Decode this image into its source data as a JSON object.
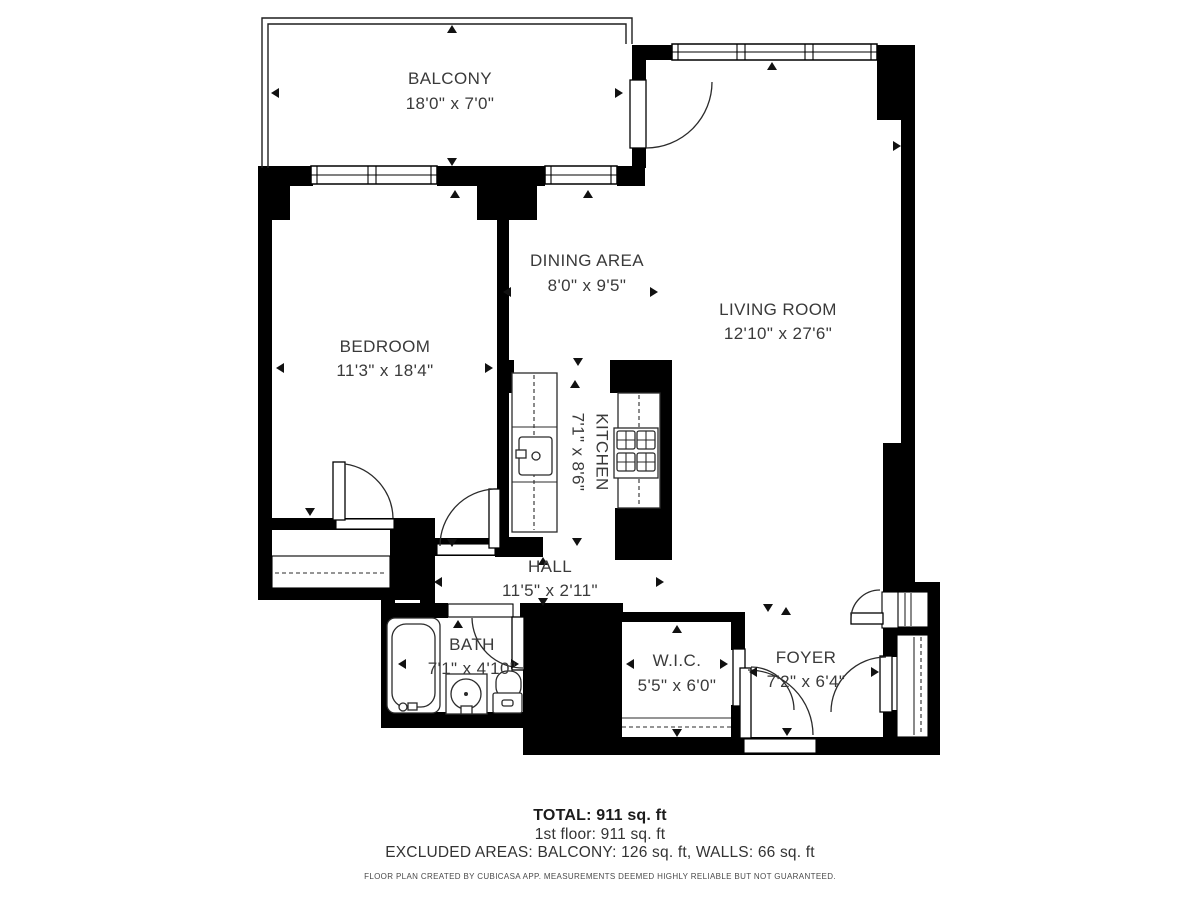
{
  "plan": {
    "colors": {
      "wall": "#000000",
      "background": "#ffffff",
      "label_text": "#3a3a3a"
    },
    "rooms": {
      "balcony": {
        "name": "BALCONY",
        "dims": "18'0\" x 7'0\""
      },
      "bedroom": {
        "name": "BEDROOM",
        "dims": "11'3\" x 18'4\""
      },
      "dining": {
        "name": "DINING AREA",
        "dims": "8'0\" x 9'5\""
      },
      "living": {
        "name": "LIVING ROOM",
        "dims": "12'10\" x 27'6\""
      },
      "kitchen": {
        "name": "KITCHEN",
        "dims": "7'1\" x 8'6\""
      },
      "hall": {
        "name": "HALL",
        "dims": "11'5\" x 2'11\""
      },
      "bath": {
        "name": "BATH",
        "dims": "7'1\" x 4'10\""
      },
      "wic": {
        "name": "W.I.C.",
        "dims": "5'5\" x 6'0\""
      },
      "foyer": {
        "name": "FOYER",
        "dims": "7'2\" x 6'4\""
      }
    },
    "footer": {
      "total": "TOTAL: 911 sq. ft",
      "floor": "1st floor: 911 sq. ft",
      "excluded": "EXCLUDED AREAS: BALCONY: 126 sq. ft, WALLS: 66 sq. ft",
      "disclaimer": "FLOOR PLAN CREATED BY CUBICASA APP. MEASUREMENTS DEEMED HIGHLY RELIABLE BUT NOT GUARANTEED."
    },
    "arrows": [
      {
        "x": 452,
        "y": 25,
        "d": "up"
      },
      {
        "x": 452,
        "y": 166,
        "d": "down"
      },
      {
        "x": 271,
        "y": 93,
        "d": "left"
      },
      {
        "x": 623,
        "y": 93,
        "d": "right"
      },
      {
        "x": 455,
        "y": 190,
        "d": "up"
      },
      {
        "x": 310,
        "y": 516,
        "d": "down"
      },
      {
        "x": 276,
        "y": 368,
        "d": "left"
      },
      {
        "x": 493,
        "y": 368,
        "d": "right"
      },
      {
        "x": 588,
        "y": 190,
        "d": "up"
      },
      {
        "x": 578,
        "y": 366,
        "d": "down"
      },
      {
        "x": 503,
        "y": 292,
        "d": "left"
      },
      {
        "x": 658,
        "y": 292,
        "d": "right"
      },
      {
        "x": 772,
        "y": 62,
        "d": "up"
      },
      {
        "x": 901,
        "y": 146,
        "d": "right"
      },
      {
        "x": 768,
        "y": 612,
        "d": "down"
      },
      {
        "x": 786,
        "y": 607,
        "d": "up"
      },
      {
        "x": 575,
        "y": 380,
        "d": "up"
      },
      {
        "x": 577,
        "y": 546,
        "d": "down"
      },
      {
        "x": 452,
        "y": 547,
        "d": "down"
      },
      {
        "x": 543,
        "y": 557,
        "d": "up"
      },
      {
        "x": 543,
        "y": 606,
        "d": "down"
      },
      {
        "x": 434,
        "y": 582,
        "d": "left"
      },
      {
        "x": 664,
        "y": 582,
        "d": "right"
      },
      {
        "x": 458,
        "y": 620,
        "d": "up"
      },
      {
        "x": 398,
        "y": 664,
        "d": "left"
      },
      {
        "x": 519,
        "y": 664,
        "d": "right"
      },
      {
        "x": 677,
        "y": 625,
        "d": "up"
      },
      {
        "x": 677,
        "y": 737,
        "d": "down"
      },
      {
        "x": 626,
        "y": 664,
        "d": "left"
      },
      {
        "x": 728,
        "y": 664,
        "d": "right"
      },
      {
        "x": 749,
        "y": 672,
        "d": "left"
      },
      {
        "x": 879,
        "y": 672,
        "d": "right"
      },
      {
        "x": 787,
        "y": 736,
        "d": "down"
      }
    ]
  }
}
